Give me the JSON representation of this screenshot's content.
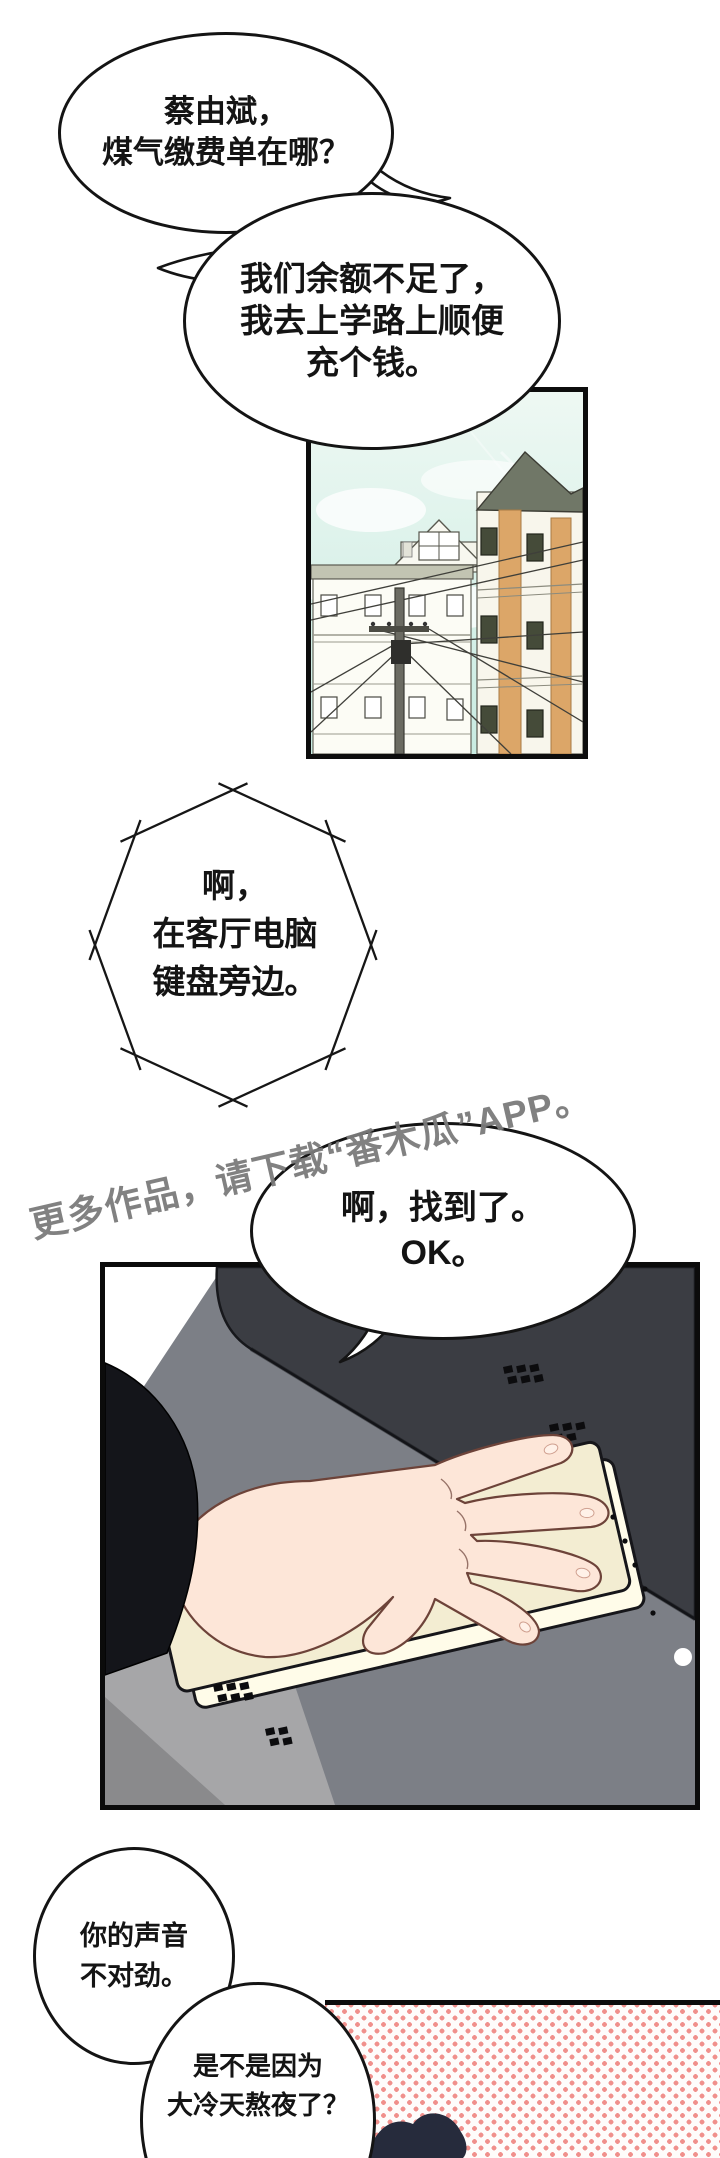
{
  "comic": {
    "bubbles": {
      "b1": {
        "lines": [
          "蔡由斌，",
          "煤气缴费单在哪？"
        ]
      },
      "b2": {
        "lines": [
          "我们余额不足了，",
          "我去上学路上顺便",
          "充个钱。"
        ]
      },
      "b3_phone": {
        "lines": [
          "啊，",
          "在客厅电脑",
          "键盘旁边。"
        ]
      },
      "b4": {
        "lines": [
          "啊，找到了。",
          "OK。"
        ]
      },
      "b5": {
        "lines": [
          "你的声音",
          "不对劲。"
        ]
      },
      "b6": {
        "lines": [
          "是不是因为",
          "大冷天熬夜了？"
        ]
      }
    },
    "watermark": {
      "text": "更多作品，请下载“番木瓜”APP。",
      "color": "#7a7a7a"
    },
    "colors": {
      "outline": "#141414",
      "sky_top": "#f0f9f4",
      "sky_bottom": "#cdeee4",
      "building_tan": "#dca668",
      "roof_green": "#707767",
      "device_dark": "#3b3d43",
      "keyboard_cream": "#f3edd2",
      "skin": "#fde6d8",
      "sleeve_black": "#14151a",
      "halftone_pink": "#f0908c",
      "hair_navy": "#262b3c"
    }
  }
}
